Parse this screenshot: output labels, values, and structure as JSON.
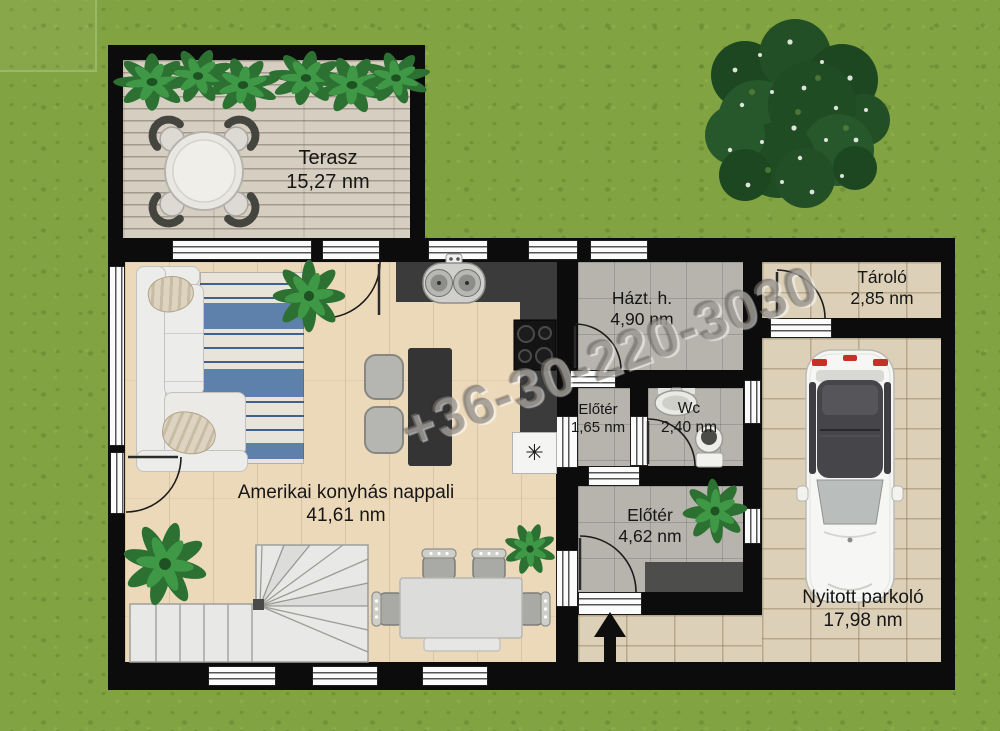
{
  "plan": {
    "watermark": "+36-30-220-3030",
    "rooms": {
      "terasz": {
        "name": "Terasz",
        "area": "15,27 nm"
      },
      "nappali": {
        "name": "Amerikai konyhás nappali",
        "area": "41,61 nm"
      },
      "haztartasi": {
        "name": "Házt. h.",
        "area": "4,90 nm"
      },
      "eloter_kis": {
        "name": "Előtér",
        "area": "1,65 nm"
      },
      "wc": {
        "name": "Wc",
        "area": "2,40 nm"
      },
      "eloter_nagy": {
        "name": "Előtér",
        "area": "4,62 nm"
      },
      "tarolo": {
        "name": "Tároló",
        "area": "2,85 nm"
      },
      "parkolo": {
        "name": "Nyitott parkoló",
        "area": "17,98 nm"
      }
    },
    "icons": {
      "freezer_snowflake": "✳"
    },
    "colors": {
      "grass": "#81a341",
      "wall": "#0c0c0c",
      "wood_floor": "#ecd9ba",
      "gray_tile": "#b7b4ae",
      "paving": "#dcd0b8",
      "deck_plank": "#d5cec1",
      "rug_blue": "#5d81aa",
      "counter": "#3b3b3b",
      "taillight_red": "#c63028"
    }
  }
}
